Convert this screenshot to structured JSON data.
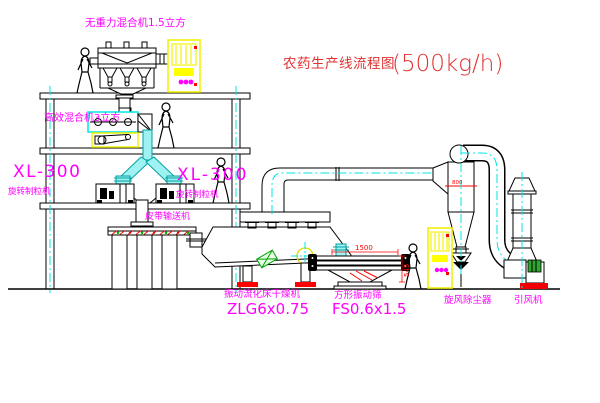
{
  "window": {
    "background": "#ffffff",
    "width": 600,
    "height": 403
  },
  "title": {
    "text_cn": "农药生产线流程图",
    "capacity": "(500kg/h)"
  },
  "equipment_labels": {
    "gravity_mixer": "无重力混合机1.5立方",
    "high_efficiency_mixer": "高效混合机3立方",
    "granulator_left": {
      "model": "XL-300",
      "name": "旋转制粒机"
    },
    "granulator_right": {
      "model": "XL-300",
      "name": "旋转制粒机"
    },
    "belt_conveyor": "皮带输送机",
    "fluid_bed_dryer": {
      "name": "振动流化床干燥机",
      "model": "ZLG6x0.75"
    },
    "vibrating_screen": {
      "name": "方形振动筛",
      "model": "FS0.6x1.5"
    },
    "cyclone": "旋风除尘器",
    "induced_draft_fan": "引风机"
  },
  "dimension_annotations": {
    "screen_length": "1500",
    "screen_outlet_height": "545",
    "cyclone_note": "800"
  },
  "colors": {
    "label_magenta": "#ff00ff",
    "title_red": "#e03030",
    "dimension_red": "#ff0000",
    "equipment_yellow": "#f2f20a",
    "pipe_cyan": "#00e5e5",
    "motor_green": "#00a000",
    "line_black": "#000000"
  }
}
